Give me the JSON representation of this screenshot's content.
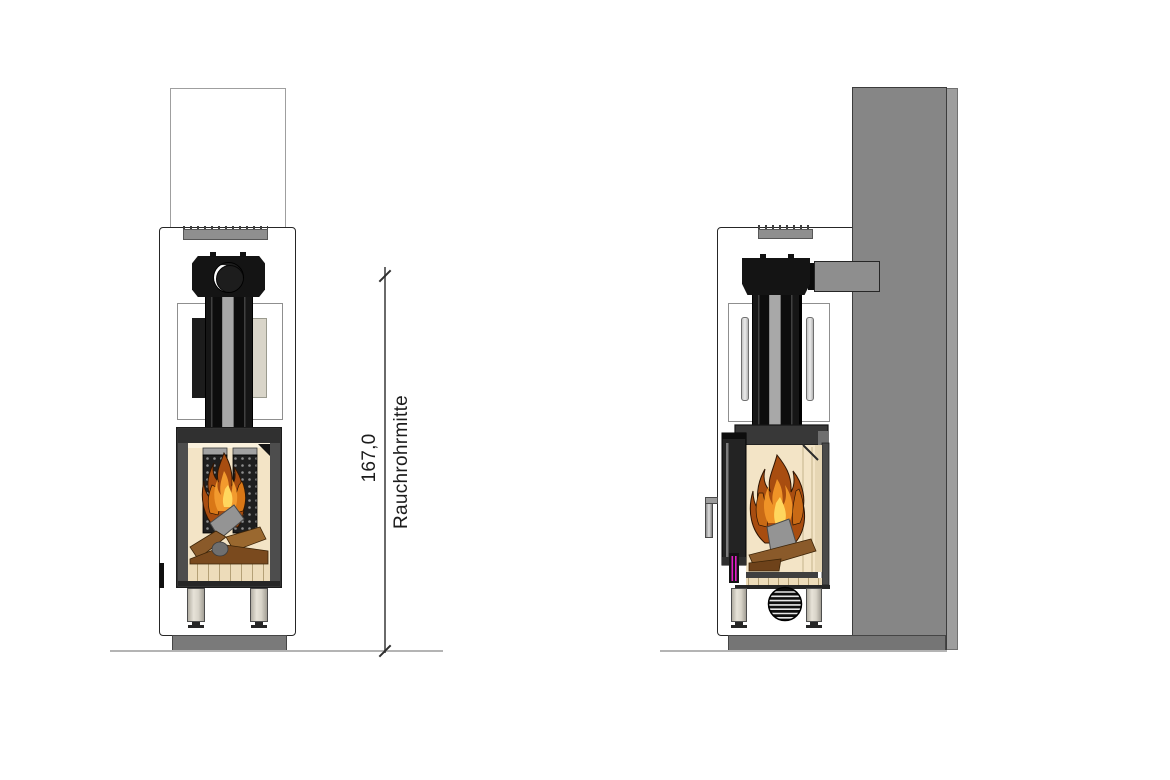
{
  "dimension": {
    "value": "167,0",
    "label": "Rauchrohrmitte"
  },
  "colors": {
    "outline": "#262626",
    "wall_gray": "#868686",
    "base_gray": "#7a7a7a",
    "top_bar_gray": "#8f8f8f",
    "leg_beige": "#d8d4c9",
    "firebox_frame": "#4d4d4d",
    "firebox_interior_cream": "#f3e4c6",
    "flame_outer": "#a84d10",
    "flame_mid": "#ef9327",
    "flame_core": "#ffd75e",
    "log_brown": "#8a5a2a",
    "reflector_gray": "#949494",
    "accent_magenta": "#e61ec8",
    "floor_line": "#b4b4b4"
  }
}
